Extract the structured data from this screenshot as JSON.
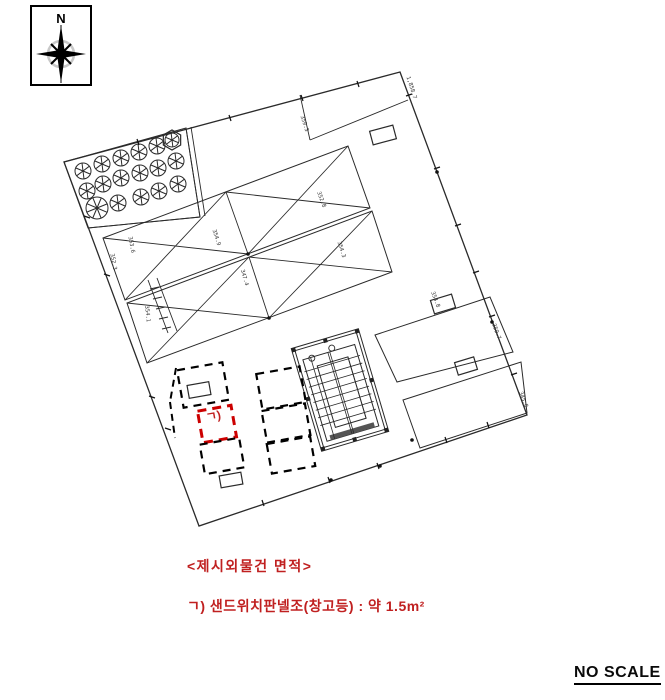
{
  "page": {
    "width": 665,
    "height": 700,
    "background": "#ffffff"
  },
  "compass": {
    "label": "N"
  },
  "notes": {
    "title": "<제시외물건 면적>",
    "item": "ㄱ) 샌드위치판넬조(창고등) : 약 1.5m²"
  },
  "scale_note": "NO SCALE",
  "colors": {
    "red": "#c02020",
    "red_box": "#cc0000",
    "ink": "#2a2a2a",
    "dim_text": "#333333"
  },
  "drawing": {
    "boundary": [
      [
        400,
        72
      ],
      [
        527,
        415
      ],
      [
        199,
        526
      ],
      [
        64,
        162
      ]
    ],
    "polygons": [
      {
        "name": "tree-band",
        "pts": [
          [
            64,
            162
          ],
          [
            186,
            128
          ],
          [
            200,
            217
          ],
          [
            88,
            228
          ]
        ]
      },
      {
        "name": "greenhouse-band-a",
        "pts": [
          [
            103,
            238
          ],
          [
            348,
            146
          ],
          [
            370,
            208
          ],
          [
            125,
            300
          ]
        ]
      },
      {
        "name": "greenhouse-band-b",
        "pts": [
          [
            127,
            303
          ],
          [
            372,
            211
          ],
          [
            392,
            272
          ],
          [
            147,
            363
          ]
        ]
      },
      {
        "name": "parcel-p1",
        "pts": [
          [
            375,
            335
          ],
          [
            490,
            297
          ],
          [
            513,
            352
          ],
          [
            397,
            382
          ]
        ]
      },
      {
        "name": "parcel-p2",
        "pts": [
          [
            403,
            400
          ],
          [
            521,
            362
          ],
          [
            527,
            413
          ],
          [
            420,
            448
          ]
        ]
      }
    ],
    "lines": [
      [
        88,
        228,
        200,
        217
      ],
      [
        186,
        128,
        200,
        217
      ],
      [
        191,
        127,
        205,
        216
      ],
      [
        300,
        95,
        310,
        140
      ],
      [
        310,
        140,
        408,
        100
      ],
      [
        148,
        280,
        168,
        333
      ],
      [
        157,
        278,
        177,
        331
      ],
      [
        150,
        289,
        159,
        287
      ],
      [
        153,
        299,
        162,
        297
      ],
      [
        156,
        309,
        165,
        307
      ],
      [
        159,
        319,
        168,
        317
      ],
      [
        162,
        329,
        171,
        327
      ],
      [
        226,
        192,
        248,
        254
      ],
      [
        103,
        238,
        248,
        254
      ],
      [
        125,
        300,
        226,
        192
      ],
      [
        226,
        192,
        370,
        208
      ],
      [
        248,
        254,
        348,
        146
      ],
      [
        249,
        257,
        269,
        318
      ],
      [
        127,
        303,
        269,
        318
      ],
      [
        147,
        363,
        249,
        257
      ],
      [
        249,
        257,
        392,
        272
      ],
      [
        269,
        318,
        372,
        211
      ]
    ],
    "dashed_segments": [
      [
        176,
        368,
        170,
        402
      ],
      [
        170,
        402,
        175,
        438
      ]
    ],
    "trees": {
      "default_r": 8,
      "items": [
        [
          157,
          146
        ],
        [
          139,
          152
        ],
        [
          121,
          158
        ],
        [
          102,
          164
        ],
        [
          83,
          171
        ],
        [
          176,
          161
        ],
        [
          158,
          168
        ],
        [
          140,
          173
        ],
        [
          121,
          178
        ],
        [
          103,
          184
        ],
        [
          87,
          191
        ],
        [
          178,
          184
        ],
        [
          159,
          191
        ],
        [
          141,
          197
        ],
        [
          118,
          203
        ]
      ],
      "big": [
        97,
        208,
        11
      ],
      "hex": [
        172,
        140,
        10
      ]
    },
    "building": {
      "cx": 340,
      "cy": 390,
      "w": 70,
      "h": 107,
      "rot": -16.5,
      "rects": [
        [
          0,
          0,
          70,
          107
        ],
        [
          3,
          3,
          64,
          101
        ],
        [
          8,
          14,
          54,
          85
        ],
        [
          20,
          24,
          32,
          64
        ]
      ],
      "fill_rect": [
        12,
        94,
        46,
        5
      ],
      "lines": [
        [
          6,
          26,
          64,
          26
        ],
        [
          6,
          34,
          64,
          34
        ],
        [
          6,
          42,
          64,
          42
        ],
        [
          6,
          50,
          64,
          50
        ],
        [
          6,
          58,
          64,
          58
        ],
        [
          6,
          66,
          64,
          66
        ],
        [
          6,
          74,
          64,
          74
        ],
        [
          6,
          82,
          64,
          82
        ],
        [
          16,
          14,
          16,
          99
        ],
        [
          34,
          14,
          34,
          99
        ],
        [
          36,
          14,
          36,
          99
        ],
        [
          52,
          24,
          52,
          88
        ]
      ],
      "circles": [
        [
          17,
          15,
          3
        ],
        [
          39,
          11,
          3
        ]
      ],
      "posts": [
        [
          0,
          0
        ],
        [
          66,
          0
        ],
        [
          0,
          51
        ],
        [
          66,
          51
        ],
        [
          0,
          103
        ],
        [
          66,
          103
        ],
        [
          33,
          0
        ],
        [
          33,
          103
        ]
      ]
    },
    "dashed_boxes": [
      {
        "cx": 203,
        "cy": 385,
        "w": 46,
        "h": 38,
        "rot": -10,
        "color": "black"
      },
      {
        "cx": 217,
        "cy": 424,
        "w": 34,
        "h": 32,
        "rot": -10,
        "color": "red"
      },
      {
        "cx": 222,
        "cy": 456,
        "w": 40,
        "h": 30,
        "rot": -10,
        "color": "black"
      },
      {
        "cx": 281,
        "cy": 388,
        "w": 44,
        "h": 36,
        "rot": -10,
        "color": "black"
      },
      {
        "cx": 286,
        "cy": 423,
        "w": 44,
        "h": 32,
        "rot": -10,
        "color": "black"
      },
      {
        "cx": 291,
        "cy": 455,
        "w": 44,
        "h": 30,
        "rot": -10,
        "color": "black"
      }
    ],
    "solid_rects": [
      [
        383,
        135,
        24,
        14,
        -15
      ],
      [
        443,
        304,
        22,
        14,
        -17
      ],
      [
        466,
        366,
        20,
        13,
        -17
      ],
      [
        199,
        390,
        22,
        13,
        -10
      ],
      [
        231,
        480,
        22,
        12,
        -10
      ]
    ],
    "ticks": [
      [
        406,
        96,
        412,
        94
      ],
      [
        434,
        169,
        440,
        167
      ],
      [
        455,
        226,
        461,
        224
      ],
      [
        473,
        273,
        479,
        271
      ],
      [
        489,
        317,
        495,
        315
      ],
      [
        511,
        375,
        517,
        373
      ],
      [
        137,
        139,
        139,
        145
      ],
      [
        229,
        115,
        231,
        121
      ],
      [
        301,
        95,
        303,
        101
      ],
      [
        357,
        81,
        359,
        87
      ],
      [
        262,
        500,
        264,
        506
      ],
      [
        328,
        477,
        330,
        483
      ],
      [
        377,
        463,
        379,
        469
      ],
      [
        445,
        437,
        447,
        443
      ],
      [
        487,
        422,
        489,
        428
      ],
      [
        84,
        216,
        90,
        218
      ],
      [
        104,
        274,
        110,
        276
      ],
      [
        149,
        396,
        155,
        398
      ],
      [
        165,
        428,
        171,
        430
      ]
    ],
    "dots": [
      [
        380,
        466
      ],
      [
        331,
        480
      ],
      [
        492,
        322
      ],
      [
        248,
        254
      ],
      [
        269,
        318
      ],
      [
        437,
        172
      ],
      [
        412,
        440
      ]
    ],
    "dims": [
      {
        "x": 410,
        "y": 88,
        "rot": 72,
        "t": "1,858.7"
      },
      {
        "x": 303,
        "y": 124,
        "rot": 72,
        "t": "359.3"
      },
      {
        "x": 215,
        "y": 238,
        "rot": 72,
        "t": "354.9"
      },
      {
        "x": 320,
        "y": 200,
        "rot": 70,
        "t": "352.8"
      },
      {
        "x": 340,
        "y": 250,
        "rot": 72,
        "t": "354.3"
      },
      {
        "x": 243,
        "y": 278,
        "rot": 74,
        "t": "347.4"
      },
      {
        "x": 495,
        "y": 332,
        "rot": 70,
        "t": "359.7"
      },
      {
        "x": 522,
        "y": 400,
        "rot": 70,
        "t": "345.8"
      },
      {
        "x": 112,
        "y": 262,
        "rot": 80,
        "t": "352.3"
      },
      {
        "x": 146,
        "y": 314,
        "rot": 84,
        "t": "354.1"
      },
      {
        "x": 130,
        "y": 245,
        "rot": 80,
        "t": "353.6"
      },
      {
        "x": 434,
        "y": 300,
        "rot": 70,
        "t": "354.8"
      }
    ],
    "red_label": {
      "x": 214,
      "y": 420,
      "rot": -10,
      "text": "ㄱ)"
    }
  }
}
